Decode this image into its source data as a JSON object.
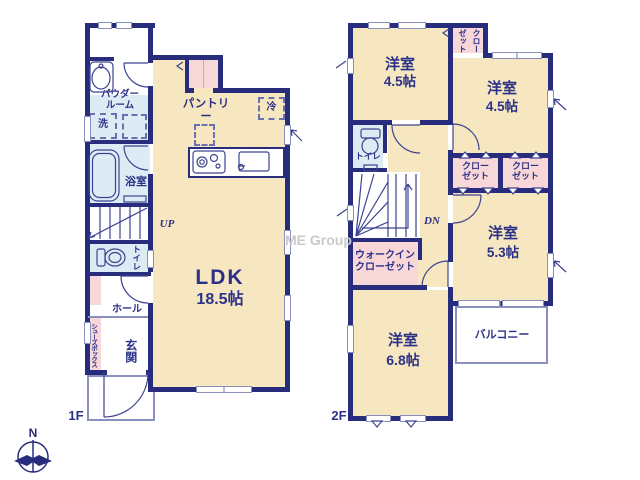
{
  "watermark": "ME Group",
  "compass": {
    "north": "N"
  },
  "colors": {
    "wall": "#272c7c",
    "room_beige": "#f7e7c1",
    "wet_area_blue": "#dcebf4",
    "storage_pink": "#f8d7d8",
    "label_navy": "#2b3188",
    "watermark_gray": "#c9c9c9"
  },
  "floor1": {
    "label": "1F",
    "rooms": {
      "powder_room": "パウダー\nルーム",
      "laundry": "洗",
      "bath": "浴室",
      "stairs_up": "UP",
      "toilet": "トイレ",
      "hall": "ホール",
      "shoe_box": "シューズボックス",
      "entrance": "玄関",
      "ldk": "LDK",
      "ldk_size": "18.5帖",
      "pantry": "パントリー",
      "fridge": "冷"
    }
  },
  "floor2": {
    "label": "2F",
    "rooms": {
      "bedroom_a": "洋室",
      "bedroom_a_size": "4.5帖",
      "closet_top": "クロー\nゼット",
      "bedroom_b": "洋室",
      "bedroom_b_size": "4.5帖",
      "closet_a": "クロー\nゼット",
      "closet_b": "クロー\nゼット",
      "bedroom_c": "洋室",
      "bedroom_c_size": "5.3帖",
      "balcony": "バルコニー",
      "toilet": "トイレ",
      "stairs_down": "DN",
      "walk_in_closet": "ウォークイン\nクローゼット",
      "bedroom_d": "洋室",
      "bedroom_d_size": "6.8帖"
    }
  }
}
